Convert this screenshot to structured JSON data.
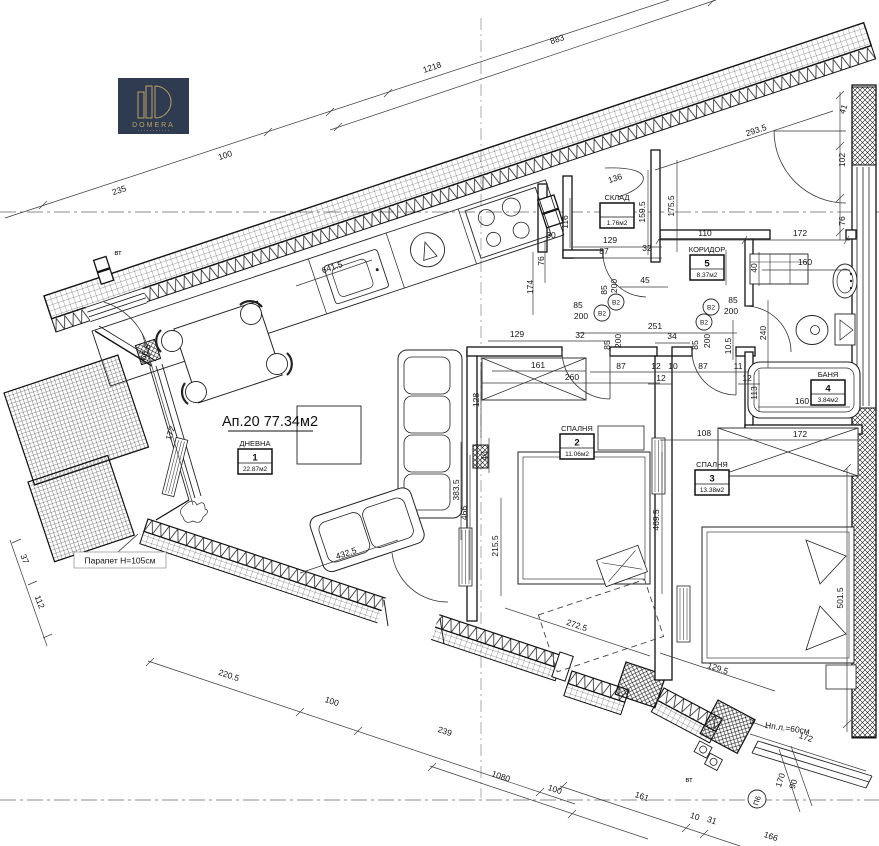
{
  "logo": {
    "brand": "DOMERA"
  },
  "apartment": {
    "label": "Ап.20 77.34м2"
  },
  "rooms": [
    {
      "name": "ДНЕВНА",
      "number": "1",
      "area": "22.87м2",
      "cx": 255,
      "cy": 446
    },
    {
      "name": "СПАЛНЯ",
      "number": "2",
      "area": "11.06м2",
      "cx": 577,
      "cy": 431
    },
    {
      "name": "СПАЛНЯ",
      "number": "3",
      "area": "13.38м2",
      "cx": 712,
      "cy": 467
    },
    {
      "name": "БАНЯ",
      "number": "4",
      "area": "3.84м2",
      "cx": 828,
      "cy": 377
    },
    {
      "name": "КОРИДОР",
      "number": "5",
      "area": "8.37м2",
      "cx": 707,
      "cy": 252
    },
    {
      "name": "СКЛАД",
      "number": "",
      "area": "1.76м2",
      "cx": 617,
      "cy": 200
    }
  ],
  "annotations": {
    "parapet": "Парапет Н=105см",
    "sill": "Нп.л.=60см",
    "vent": "вт",
    "axis_marker": "П6",
    "door_marker": "В2",
    "leader_num": "3"
  },
  "door_markers": [
    {
      "x": 602,
      "y": 313
    },
    {
      "x": 616,
      "y": 302
    },
    {
      "x": 711,
      "y": 307
    },
    {
      "x": 704,
      "y": 322
    }
  ],
  "dimensions": [
    {
      "t": "1218",
      "x": 433,
      "y": 70,
      "r": -18.5
    },
    {
      "t": "883",
      "x": 558,
      "y": 42,
      "r": -18.5
    },
    {
      "t": "235",
      "x": 120,
      "y": 193,
      "r": -18.5
    },
    {
      "t": "100",
      "x": 226,
      "y": 158,
      "r": -18.5
    },
    {
      "t": "293.5",
      "x": 757,
      "y": 133,
      "r": -18.5
    },
    {
      "t": "136",
      "x": 616,
      "y": 181,
      "r": -18.5
    },
    {
      "t": "641.5",
      "x": 333,
      "y": 270,
      "r": -18.5
    },
    {
      "t": "41",
      "x": 846,
      "y": 110,
      "r": -71.5
    },
    {
      "t": "102",
      "x": 845,
      "y": 160,
      "r": -90
    },
    {
      "t": "76",
      "x": 845,
      "y": 221,
      "r": -90
    },
    {
      "t": "174",
      "x": 533,
      "y": 287,
      "r": -90
    },
    {
      "t": "76",
      "x": 544,
      "y": 261,
      "r": -90
    },
    {
      "t": "30",
      "x": 551,
      "y": 238,
      "r": 0
    },
    {
      "t": "116",
      "x": 568,
      "y": 222,
      "r": -90
    },
    {
      "t": "159.5",
      "x": 645,
      "y": 212,
      "r": -90
    },
    {
      "t": "175.5",
      "x": 674,
      "y": 206,
      "r": -90
    },
    {
      "t": "129",
      "x": 610,
      "y": 243,
      "r": 0
    },
    {
      "t": "87",
      "x": 604,
      "y": 254,
      "r": 0
    },
    {
      "t": "32",
      "x": 647,
      "y": 251,
      "r": 0
    },
    {
      "t": "45",
      "x": 645,
      "y": 283,
      "r": 0
    },
    {
      "t": "85",
      "x": 607,
      "y": 290,
      "r": -90
    },
    {
      "t": "200",
      "x": 617,
      "y": 286,
      "r": -90
    },
    {
      "t": "110",
      "x": 705,
      "y": 236,
      "r": 0
    },
    {
      "t": "172",
      "x": 800,
      "y": 236,
      "r": 0
    },
    {
      "t": "160",
      "x": 805,
      "y": 265,
      "r": 0
    },
    {
      "t": "52",
      "x": 724,
      "y": 267,
      "r": -90
    },
    {
      "t": "40",
      "x": 757,
      "y": 268,
      "r": -90
    },
    {
      "t": "85",
      "x": 578,
      "y": 308,
      "r": 0
    },
    {
      "t": "200",
      "x": 581,
      "y": 319,
      "r": 0
    },
    {
      "t": "85",
      "x": 733,
      "y": 303,
      "r": 0
    },
    {
      "t": "200",
      "x": 731,
      "y": 314,
      "r": 0
    },
    {
      "t": "251",
      "x": 655,
      "y": 329,
      "r": 0
    },
    {
      "t": "34",
      "x": 672,
      "y": 339,
      "r": 0
    },
    {
      "t": "32",
      "x": 580,
      "y": 338,
      "r": 0
    },
    {
      "t": "85",
      "x": 610,
      "y": 345,
      "r": -90
    },
    {
      "t": "200",
      "x": 621,
      "y": 341,
      "r": -90
    },
    {
      "t": "85",
      "x": 698,
      "y": 345,
      "r": -90
    },
    {
      "t": "200",
      "x": 710,
      "y": 341,
      "r": -90
    },
    {
      "t": "10.5",
      "x": 731,
      "y": 346,
      "r": -90
    },
    {
      "t": "240",
      "x": 766,
      "y": 333,
      "r": -90
    },
    {
      "t": "87",
      "x": 621,
      "y": 369,
      "r": 0
    },
    {
      "t": "12",
      "x": 656,
      "y": 369,
      "r": 0
    },
    {
      "t": "10",
      "x": 673,
      "y": 369,
      "r": 0
    },
    {
      "t": "87",
      "x": 703,
      "y": 369,
      "r": 0
    },
    {
      "t": "11",
      "x": 738,
      "y": 369,
      "r": 0
    },
    {
      "t": "12",
      "x": 661,
      "y": 381,
      "r": 0
    },
    {
      "t": "12",
      "x": 747,
      "y": 381,
      "r": 0
    },
    {
      "t": "113",
      "x": 757,
      "y": 393,
      "r": -90
    },
    {
      "t": "129",
      "x": 517,
      "y": 337,
      "r": 0
    },
    {
      "t": "161",
      "x": 538,
      "y": 368,
      "r": 0
    },
    {
      "t": "260",
      "x": 572,
      "y": 380,
      "r": 0
    },
    {
      "t": "128",
      "x": 479,
      "y": 400,
      "r": -90
    },
    {
      "t": "40",
      "x": 487,
      "y": 456,
      "r": -90
    },
    {
      "t": "108",
      "x": 704,
      "y": 436,
      "r": 0
    },
    {
      "t": "160",
      "x": 802,
      "y": 404,
      "r": 0
    },
    {
      "t": "172",
      "x": 800,
      "y": 437,
      "r": 0
    },
    {
      "t": "501.5",
      "x": 843,
      "y": 598,
      "r": -90
    },
    {
      "t": "469.5",
      "x": 659,
      "y": 520,
      "r": -90
    },
    {
      "t": "466",
      "x": 467,
      "y": 513,
      "r": -90
    },
    {
      "t": "383.5",
      "x": 459,
      "y": 490,
      "r": -90
    },
    {
      "t": "215.5",
      "x": 498,
      "y": 546,
      "r": -90
    },
    {
      "t": "272.5",
      "x": 576,
      "y": 628,
      "r": 18.5
    },
    {
      "t": "129.5",
      "x": 717,
      "y": 671,
      "r": 18.5
    },
    {
      "t": "432.5",
      "x": 347,
      "y": 556,
      "r": -18.5
    },
    {
      "t": "66.5",
      "x": 148,
      "y": 353,
      "r": -72
    },
    {
      "t": "172",
      "x": 173,
      "y": 434,
      "r": -72
    },
    {
      "t": "37",
      "x": 22,
      "y": 560,
      "r": 68
    },
    {
      "t": "112",
      "x": 37,
      "y": 603,
      "r": 68
    },
    {
      "t": "220.5",
      "x": 228,
      "y": 678,
      "r": 18.5
    },
    {
      "t": "100",
      "x": 331,
      "y": 704,
      "r": 18.5
    },
    {
      "t": "239",
      "x": 444,
      "y": 734,
      "r": 18.5
    },
    {
      "t": "1080",
      "x": 500,
      "y": 779,
      "r": 18.5
    },
    {
      "t": "100",
      "x": 554,
      "y": 792,
      "r": 18.5
    },
    {
      "t": "161",
      "x": 641,
      "y": 799,
      "r": 18.5
    },
    {
      "t": "10",
      "x": 694,
      "y": 819,
      "r": 18.5
    },
    {
      "t": "31",
      "x": 711,
      "y": 823,
      "r": 18.5
    },
    {
      "t": "166",
      "x": 770,
      "y": 839,
      "r": 18.5
    },
    {
      "t": "170",
      "x": 783,
      "y": 781,
      "r": -72
    },
    {
      "t": "90",
      "x": 796,
      "y": 785,
      "r": -72
    },
    {
      "t": "172",
      "x": 805,
      "y": 740,
      "r": 18.5
    }
  ]
}
